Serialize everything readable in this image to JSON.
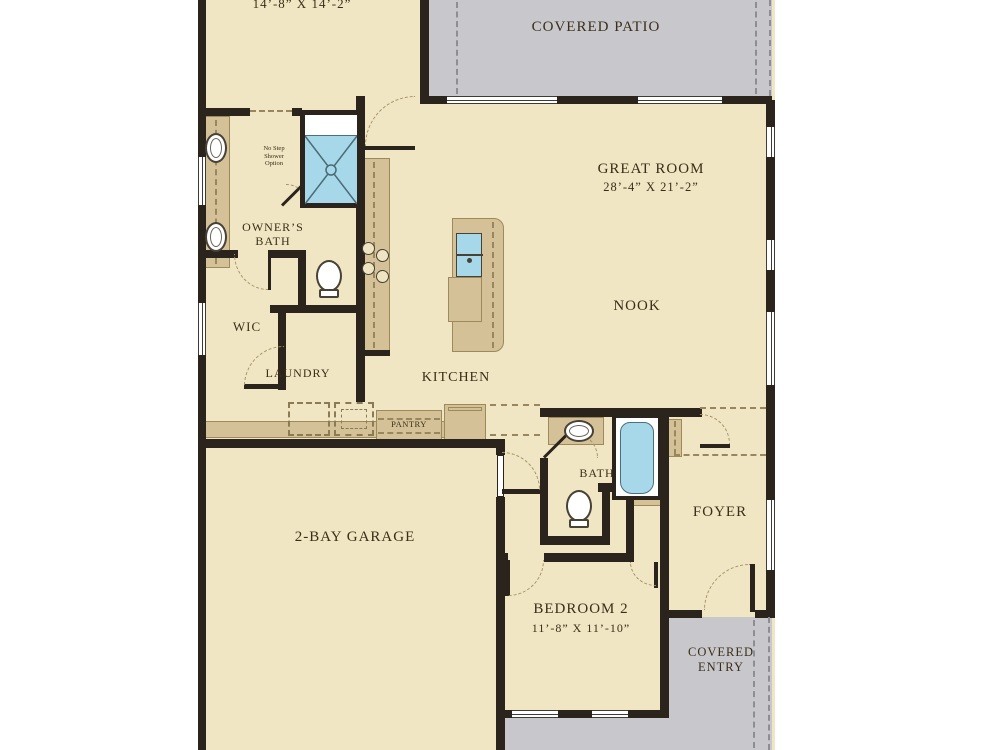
{
  "plan_type": "single-story-home-floor-plan",
  "colors": {
    "floor": "#f1e6c3",
    "wall": "#2b241c",
    "counter": "#d5c197",
    "outdoor_concrete": "#c8c8cc",
    "fixture_blue": "#a7d8e9",
    "label_text": "#3a2e18"
  },
  "rooms": {
    "owners_suite": {
      "dims": "14’-8” X 14’-2”"
    },
    "covered_patio": {
      "label": "COVERED PATIO"
    },
    "great_room": {
      "label": "GREAT ROOM",
      "dims": "28’-4” X 21’-2”"
    },
    "nook": {
      "label": "NOOK"
    },
    "owners_bath": {
      "label": "OWNER’S BATH",
      "note": "No Step Shower Option"
    },
    "wic": {
      "label": "WIC"
    },
    "laundry": {
      "label": "LAUNDRY"
    },
    "kitchen": {
      "label": "KITCHEN"
    },
    "pantry": {
      "label": "PANTRY"
    },
    "bath2": {
      "label": "BATH"
    },
    "foyer": {
      "label": "FOYER"
    },
    "bedroom2": {
      "label": "BEDROOM 2",
      "dims": "11’-8” X 11’-10”"
    },
    "garage": {
      "label": "2-BAY GARAGE"
    },
    "covered_entry": {
      "label": "COVERED ENTRY"
    }
  }
}
